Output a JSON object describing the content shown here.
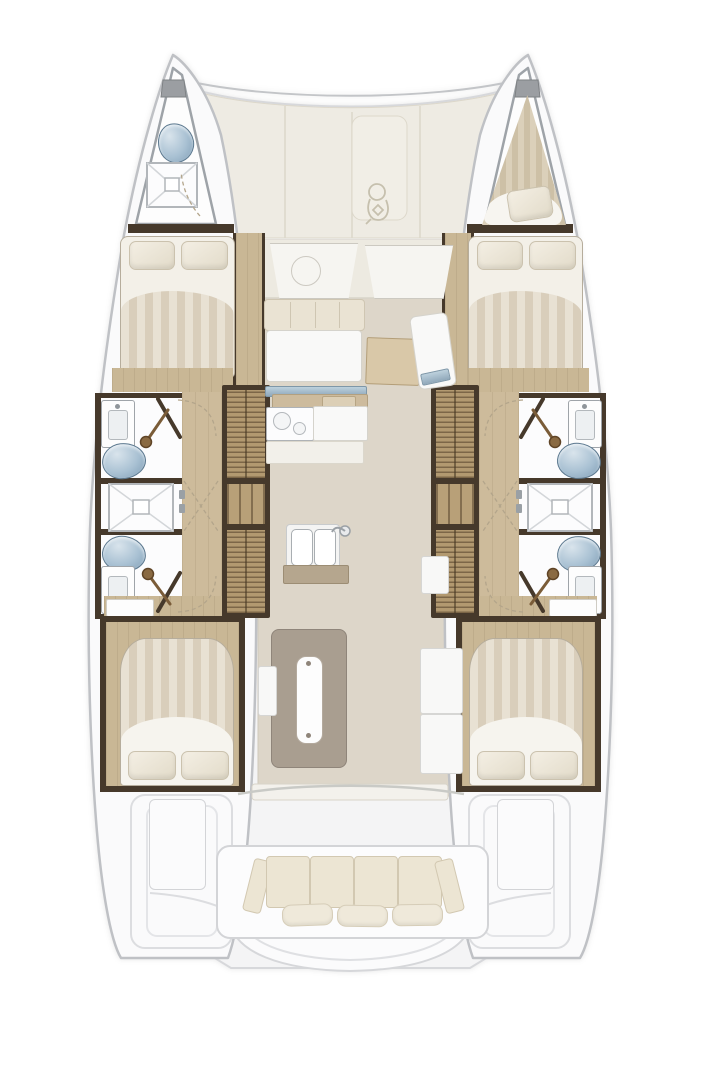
{
  "meta": {
    "title": "Catamaran interior floor plan",
    "type": "boat-floorplan",
    "orientation": "bow-up",
    "text_on_image": "none"
  },
  "palette": {
    "page_bg": "#ffffff",
    "hull_fill": "#fafafb",
    "hull_stroke": "#bfc1c5",
    "deck_cream": "#eeebe3",
    "deck_seam": "#dcd7ca",
    "saloon_floor": "#ddd6c9",
    "wood_floor": "#c9b795",
    "stair_wood": "#b29970",
    "dark_wood_wall": "#46392b",
    "duvet_stripe_light": "#e8e1d3",
    "duvet_stripe_dark": "#d9cebb",
    "pillow": "#efe9da",
    "toilet_blue": "#a9c1d3",
    "window_blue": "#a7bfcf",
    "nav_desk_tan": "#d9c8a8",
    "island_gray": "#a99e90",
    "bench_cushion": "#ece5d3"
  },
  "inventory": {
    "port_hull": [
      "bow head with toilet and shower tray",
      "anchor locker",
      "forward double cabin with two pillows",
      "bathroom with sink, handheld shower and toilet",
      "central shower stall",
      "second bathroom mirrored",
      "companionway stairs",
      "aft double cabin with two pillows"
    ],
    "starboard_hull": [
      "bow v-berth with cushion",
      "anchor locker",
      "forward double cabin with two pillows",
      "bathroom with sink, handheld shower and toilet",
      "central shower stall",
      "second bathroom mirrored",
      "companionway stairs",
      "aft double cabin with two pillows"
    ],
    "centerline": [
      "foredeck panels with hatch and windlass",
      "two forward cockpit seats with table ring",
      "saloon sofa and table",
      "navigation desk with seat",
      "galley counter with cooktop and double sink",
      "galley island unit",
      "aft sliding-door sill",
      "cockpit bench with four back cushions and three pillows",
      "two cockpit side lockers",
      "transom steps on both hulls",
      "central swim platform"
    ]
  },
  "counts": {
    "cabins": 4,
    "bathrooms": 4,
    "shower_stalls": 3,
    "toilets": 5,
    "sinks_bathroom": 4,
    "bed_pillows": 8,
    "cockpit_pillows": 3
  }
}
